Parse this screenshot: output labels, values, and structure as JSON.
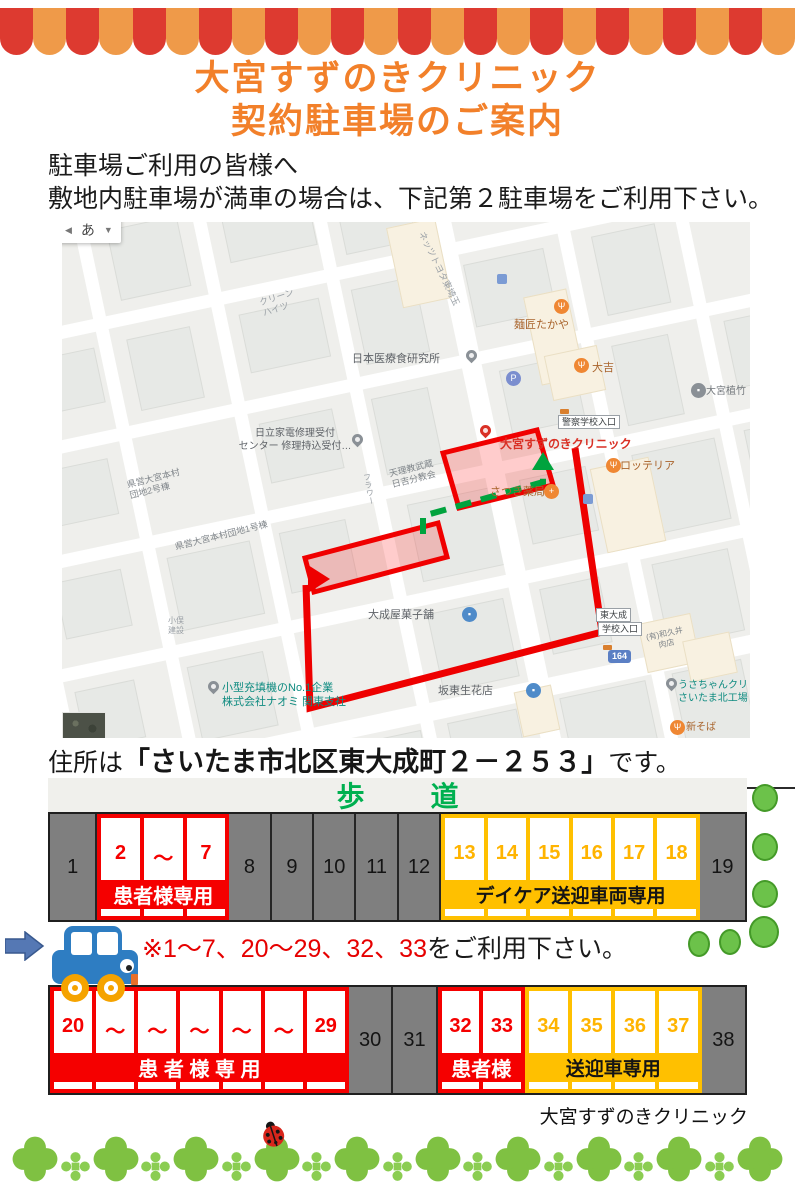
{
  "header": {
    "title_line1": "大宮すずのきクリニック",
    "title_line2": "契約駐車場のご案内",
    "intro_line1": "駐車場ご利用の皆様へ",
    "intro_line2": "敷地内駐車場が満車の場合は、下記第２駐車場をご利用下さい。"
  },
  "colors": {
    "title_orange": "#f2802a",
    "awning_red": "#dd3a30",
    "awning_orange": "#ef9a49",
    "parking_red": "#f50000",
    "parking_yellow": "#ffc000",
    "sidewalk_green": "#00b050",
    "route_red": "#ee0000",
    "dash_green": "#00a33e",
    "strip_gray": "#7f7f7f",
    "bush_green": "#6cc24a",
    "clover_green": "#7fc142",
    "car_blue": "#2e7dc2",
    "wheel_orange": "#f5a300"
  },
  "map": {
    "ime": {
      "back": "◀",
      "char": "あ",
      "drop": "▼"
    },
    "shield": "164",
    "labels": [
      {
        "t": "クリーン\nハイツ",
        "x": 196,
        "y": 76,
        "c": "#9aa0a6",
        "s": 9,
        "r": -18
      },
      {
        "t": "ネッツトヨタ東埼玉",
        "x": 364,
        "y": 8,
        "c": "#9aa0a6",
        "s": 9,
        "r": 64
      },
      {
        "t": "日本医療食研究所",
        "x": 290,
        "y": 131,
        "c": "#5f6368",
        "s": 11
      },
      {
        "t": "麺匠たかや",
        "x": 452,
        "y": 97,
        "c": "#a9642c",
        "s": 11
      },
      {
        "t": "大吉",
        "x": 530,
        "y": 140,
        "c": "#a9642c",
        "s": 11
      },
      {
        "t": "大宮植竹",
        "x": 644,
        "y": 164,
        "c": "#70757a",
        "s": 10
      },
      {
        "t": "日立家電修理受付\nセンター 修理持込受付…",
        "x": 166,
        "y": 206,
        "c": "#5f6368",
        "s": 10,
        "w": 134
      },
      {
        "t": "大宮すずのきクリニック",
        "x": 438,
        "y": 215,
        "c": "#d93025",
        "s": 12,
        "b": 1
      },
      {
        "t": "ロッテリア",
        "x": 558,
        "y": 238,
        "c": "#a9642c",
        "s": 11
      },
      {
        "t": "さつき薬局",
        "x": 428,
        "y": 264,
        "c": "#a9642c",
        "s": 11
      },
      {
        "t": "天理教武蔵\n日吉分教会",
        "x": 326,
        "y": 247,
        "c": "#80868b",
        "s": 9,
        "r": -14
      },
      {
        "t": "フラワー",
        "x": 299,
        "y": 252,
        "c": "#9aa0a6",
        "s": 8,
        "v": 1,
        "r": -10
      },
      {
        "t": "県営大宮本村\n団地2号棟",
        "x": 64,
        "y": 258,
        "c": "#80868b",
        "s": 9,
        "r": -14
      },
      {
        "t": "県営大宮本村団地1号棟",
        "x": 112,
        "y": 320,
        "c": "#80868b",
        "s": 9,
        "r": -14
      },
      {
        "t": "小俣\n建設",
        "x": 106,
        "y": 394,
        "c": "#9aa0a6",
        "s": 8
      },
      {
        "t": "(有)和久井\n肉店",
        "x": 580,
        "y": 412,
        "c": "#80868b",
        "s": 8,
        "r": -12,
        "w": 44
      },
      {
        "t": "大成屋菓子舗",
        "x": 306,
        "y": 387,
        "c": "#5f6368",
        "s": 11
      },
      {
        "t": "坂東生花店",
        "x": 376,
        "y": 463,
        "c": "#5f6368",
        "s": 11
      },
      {
        "t": "小型充填機のNo.1企業\n株式会社ナオミ 関東支社",
        "x": 160,
        "y": 460,
        "c": "#0e8b80",
        "s": 11
      },
      {
        "t": "うさちゃんクリ\nさいたま北工場",
        "x": 616,
        "y": 458,
        "c": "#0e8b80",
        "s": 10
      },
      {
        "t": "新そば",
        "x": 624,
        "y": 500,
        "c": "#a9642c",
        "s": 10
      }
    ],
    "icons": [
      {
        "n": "pin-icon",
        "k": "pin",
        "x": 404,
        "y": 128,
        "bg": "#8a9096"
      },
      {
        "n": "restaurant-icon",
        "k": "circle",
        "x": 492,
        "y": 77,
        "bg": "#ef8733",
        "g": "Ψ"
      },
      {
        "n": "restaurant-icon",
        "k": "circle",
        "x": 512,
        "y": 136,
        "bg": "#ef8733",
        "g": "Ψ"
      },
      {
        "n": "place-icon",
        "k": "circle",
        "x": 629,
        "y": 161,
        "bg": "#8a9096",
        "g": "▪"
      },
      {
        "n": "pin-icon",
        "k": "pin",
        "x": 290,
        "y": 212,
        "bg": "#8a9096"
      },
      {
        "n": "parking-icon",
        "k": "circle",
        "x": 444,
        "y": 149,
        "bg": "#7b8ecf",
        "g": "P"
      },
      {
        "n": "clinic-pin-icon",
        "k": "pin",
        "x": 418,
        "y": 203,
        "bg": "#d93025"
      },
      {
        "n": "restaurant-icon",
        "k": "circle",
        "x": 544,
        "y": 236,
        "bg": "#ef8733",
        "g": "Ψ"
      },
      {
        "n": "pharmacy-icon",
        "k": "circle",
        "x": 482,
        "y": 262,
        "bg": "#ef8733",
        "g": "+"
      },
      {
        "n": "shop-icon",
        "k": "circle",
        "x": 400,
        "y": 385,
        "bg": "#4f8bc9",
        "g": "▪"
      },
      {
        "n": "shop-icon",
        "k": "circle",
        "x": 464,
        "y": 461,
        "bg": "#4f8bc9",
        "g": "▪"
      },
      {
        "n": "pin-icon",
        "k": "pin",
        "x": 146,
        "y": 459,
        "bg": "#8a9096"
      },
      {
        "n": "pin-icon",
        "k": "pin",
        "x": 604,
        "y": 456,
        "bg": "#8a9096"
      },
      {
        "n": "restaurant-icon",
        "k": "circle",
        "x": 608,
        "y": 498,
        "bg": "#ef8733",
        "g": "Ψ"
      },
      {
        "n": "transit-icon",
        "k": "square",
        "x": 435,
        "y": 52,
        "bg": "#7b9bd4"
      },
      {
        "n": "transit-icon",
        "k": "square",
        "x": 521,
        "y": 272,
        "bg": "#7b9bd4"
      },
      {
        "n": "bus-icon",
        "k": "busdot",
        "x": 498,
        "y": 187,
        "bg": "#d97f2e"
      },
      {
        "n": "bus-icon",
        "k": "busdot",
        "x": 541,
        "y": 423,
        "bg": "#d97f2e"
      }
    ],
    "boxes": [
      {
        "t": "警察学校入口",
        "x": 496,
        "y": 193
      },
      {
        "t": "東大成",
        "x": 534,
        "y": 386
      },
      {
        "t": "学校入口",
        "x": 536,
        "y": 400
      }
    ],
    "shield_pos": {
      "x": 546,
      "y": 428
    }
  },
  "address": {
    "prefix": "住所は",
    "quoted": "「さいたま市北区東大成町２－２５３」",
    "suffix": "です。"
  },
  "sidewalk": {
    "left": "歩",
    "right": "道"
  },
  "lot1": {
    "cells": [
      {
        "k": "gray",
        "n": "1",
        "w": 6.8
      },
      {
        "k": "group",
        "c": "red",
        "stalls": [
          "2",
          "～",
          "7"
        ],
        "banner": "患者様専用",
        "w": 19
      },
      {
        "k": "gray",
        "n": "8",
        "w": 6.1
      },
      {
        "k": "gray",
        "n": "9",
        "w": 6.1
      },
      {
        "k": "gray",
        "n": "10",
        "w": 6.1
      },
      {
        "k": "gray",
        "n": "11",
        "w": 6.1
      },
      {
        "k": "gray",
        "n": "12",
        "w": 6.1
      },
      {
        "k": "group",
        "c": "yellow",
        "stalls": [
          "13",
          "14",
          "15",
          "16",
          "17",
          "18"
        ],
        "banner": "デイケア送迎車両専用",
        "w": 37.2
      },
      {
        "k": "gray",
        "n": "19",
        "w": 6.5
      }
    ]
  },
  "note": {
    "red": "※1～7、20～29、32、33",
    "black": "をご利用下さい。"
  },
  "lot2": {
    "cells": [
      {
        "k": "group",
        "c": "red",
        "stalls": [
          "20",
          "～",
          "～",
          "～",
          "～",
          "～",
          "29"
        ],
        "banner": "患 者 様 専 用",
        "w": 43
      },
      {
        "k": "gray",
        "n": "30",
        "w": 6.4
      },
      {
        "k": "gray",
        "n": "31",
        "w": 6.4
      },
      {
        "k": "group",
        "c": "red",
        "stalls": [
          "32",
          "33"
        ],
        "banner": "患者様",
        "w": 12.5
      },
      {
        "k": "group",
        "c": "yellow",
        "stalls": [
          "34",
          "35",
          "36",
          "37"
        ],
        "banner": "送迎車専用",
        "w": 25.5
      },
      {
        "k": "gray",
        "n": "38",
        "w": 6.2
      }
    ]
  },
  "footer": {
    "clinic_name": "大宮すずのきクリニック"
  }
}
